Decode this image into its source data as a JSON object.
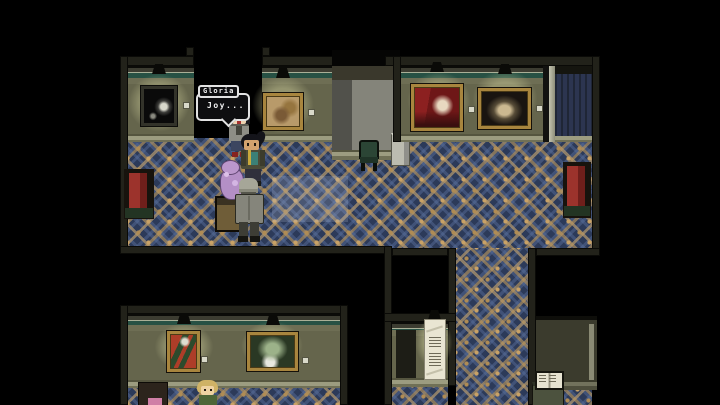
{
  "dialogue": {
    "speaker": "Gloria",
    "text": "Joy..."
  },
  "palette": {
    "void": "#000000",
    "wall_olive": "#67674e",
    "wall_dark": "#3b3b2d",
    "cornice_green": "#275144",
    "carpet_base": "#2c3a59",
    "carpet_accent": "#bf9a5e",
    "bench_cushion": "#8b2b26",
    "statue_purple": "#b48fc6",
    "spotlight_glow": "#d5d5a0",
    "frame_gold": "#a8853e"
  },
  "entities": {
    "npcs": [
      {
        "name": "gloria"
      },
      {
        "name": "ponytail-woman"
      },
      {
        "name": "gray-coat-visitor"
      },
      {
        "name": "blonde-visitor"
      }
    ],
    "paintings": [
      {
        "name": "dark-skeleton-painting"
      },
      {
        "name": "beige-classical-painting"
      },
      {
        "name": "red-rococo-painting"
      },
      {
        "name": "dark-figures-painting"
      },
      {
        "name": "orange-mantis-painting"
      },
      {
        "name": "green-landscape-painting"
      }
    ],
    "objects": [
      {
        "name": "purple-statue"
      },
      {
        "name": "flower-vase-stand"
      },
      {
        "name": "green-chair"
      },
      {
        "name": "red-bench-left"
      },
      {
        "name": "red-bench-right"
      },
      {
        "name": "wall-scroll"
      },
      {
        "name": "open-book-stand"
      }
    ]
  }
}
